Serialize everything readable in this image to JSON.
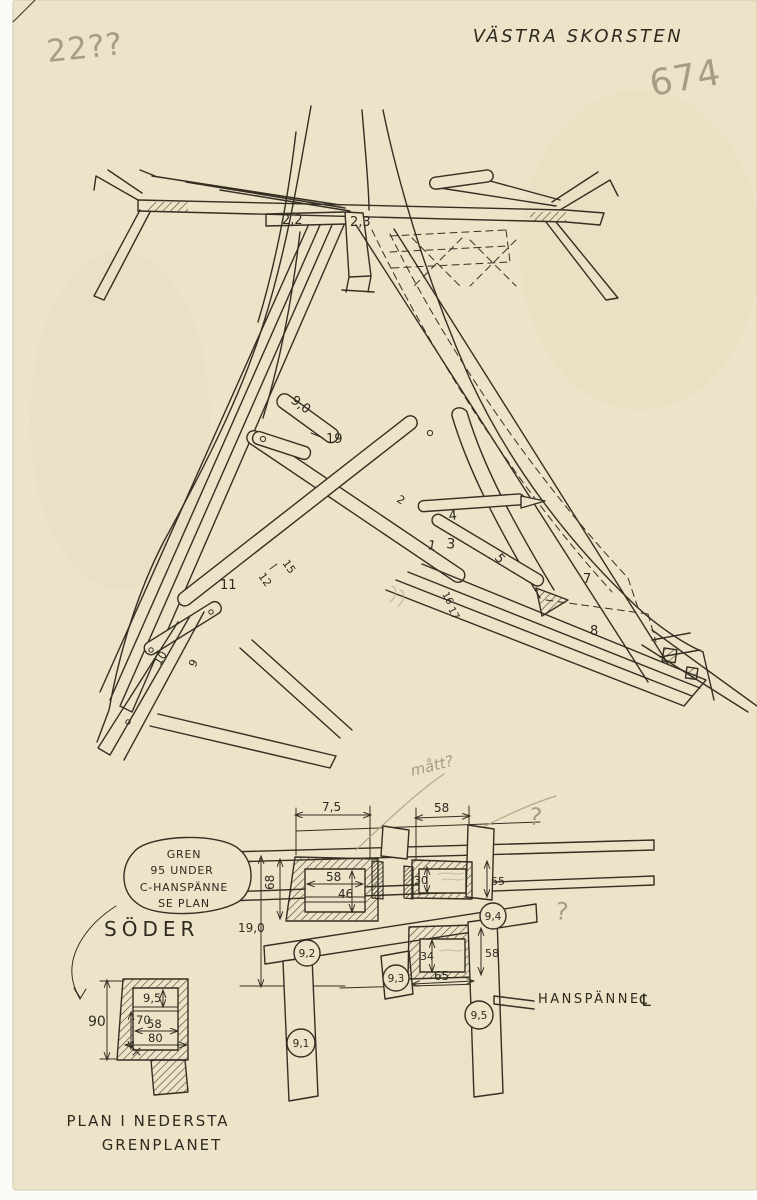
{
  "colors": {
    "paper": "#ede3c8",
    "ink": "#352e22",
    "pencil": "#a89d82"
  },
  "header": {
    "title": "VÄSTRA SKORSTEN",
    "pencil_top_left": "22??",
    "pencil_number": "674"
  },
  "truss_labels": {
    "dim_22": "2,2",
    "dim_23": "2,3",
    "dim_90": "9,0",
    "n19": "19",
    "n4": "4",
    "n1": "1",
    "n2": "2",
    "n3": "3",
    "n5": "5",
    "n7": "7",
    "n8": "8",
    "n11": "11",
    "n12": "12",
    "n15": "15",
    "n16": "16",
    "n17": "17",
    "n10": "10",
    "n9": "9"
  },
  "bubble": {
    "line1": "GREN",
    "line2": "95 UNDER",
    "line3": "C-HANSPÄNNE",
    "line4": "SE PLAN"
  },
  "labels": {
    "soder": "SÖDER",
    "hanspanne": "HANSPÄNNE",
    "centerline": "℄",
    "pencil_matt": "mått?",
    "pencil_q1": "?",
    "pencil_q2": "?"
  },
  "plan": {
    "dim_75": "7,5",
    "dim_58_top": "58",
    "dim_68": "68",
    "dim_190": "19,0",
    "dim_58_inner": "58",
    "dim_46": "46",
    "dim_30": "30",
    "dim_55": "55",
    "dim_34": "34",
    "dim_58_right": "58",
    "dim_65": "65",
    "c91": "9,1",
    "c92": "9,2",
    "c93": "9,3",
    "c94": "9,4",
    "c95": "9,5"
  },
  "small_plan": {
    "dim_90": "90",
    "dim_95": "9,5",
    "dim_70": "70",
    "dim_58": "58",
    "dim_80": "80",
    "caption_line1": "PLAN I NEDERSTA",
    "caption_line2": "GRENPLANET"
  }
}
